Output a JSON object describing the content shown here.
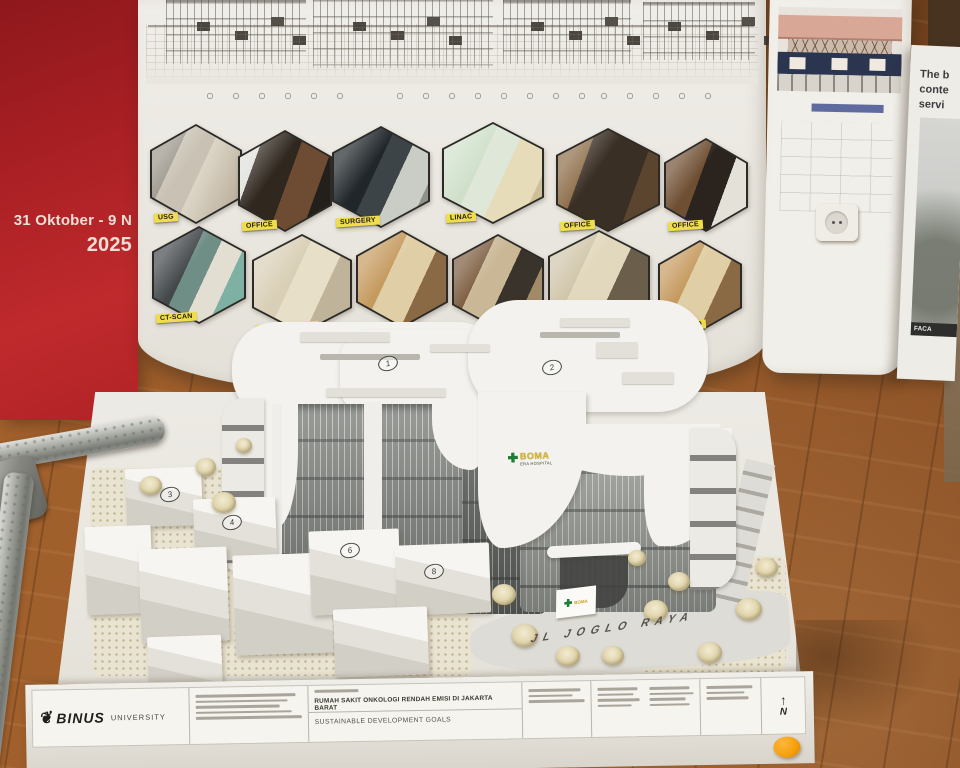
{
  "banner": {
    "line1": "31 Oktober - 9 N",
    "line2": "2025"
  },
  "poster": {
    "rooms_row1": [
      {
        "label": "USG"
      },
      {
        "label": "OFFICE"
      },
      {
        "label": "SURGERY"
      },
      {
        "label": "LINAC"
      },
      {
        "label": "OFFICE"
      },
      {
        "label": "OFFICE"
      }
    ],
    "rooms_row2": [
      {
        "label": "CT-SCAN"
      },
      {
        "label": "PATIENT WARD"
      },
      {
        "label": ""
      },
      {
        "label": ""
      },
      {
        "label": ""
      },
      {
        "label": "VIP WARD"
      }
    ]
  },
  "side_poster": {
    "paragraph_lines": [
      "The b",
      "conte",
      "servi"
    ],
    "image_caption": "FACA"
  },
  "model": {
    "building_sign_name": "BOMA",
    "building_sign_subtitle": "ERA HOSPITAL",
    "entrance_sign_name": "BOMA",
    "road_label": "JL JOGLO RAYA",
    "roof_markers": [
      {
        "num": "1"
      },
      {
        "num": "2"
      }
    ],
    "block_markers": [
      {
        "num": "3"
      },
      {
        "num": "4"
      },
      {
        "num": "6"
      },
      {
        "num": "8"
      }
    ]
  },
  "titleblock": {
    "brand": "BINUS",
    "brand_suffix": "UNIVERSITY",
    "project_title": "RUMAH SAKIT ONKOLOGI RENDAH EMISI DI JAKARTA BARAT",
    "project_subtitle": "SUSTAINABLE DEVELOPMENT GOALS",
    "north": "N"
  },
  "colors": {
    "banner_red": "#b02125",
    "label_yellow": "#f0dd4e",
    "cross_green": "#1e7d34",
    "boma_gold": "#d8b428",
    "sticker_orange": "#f59e0b"
  }
}
